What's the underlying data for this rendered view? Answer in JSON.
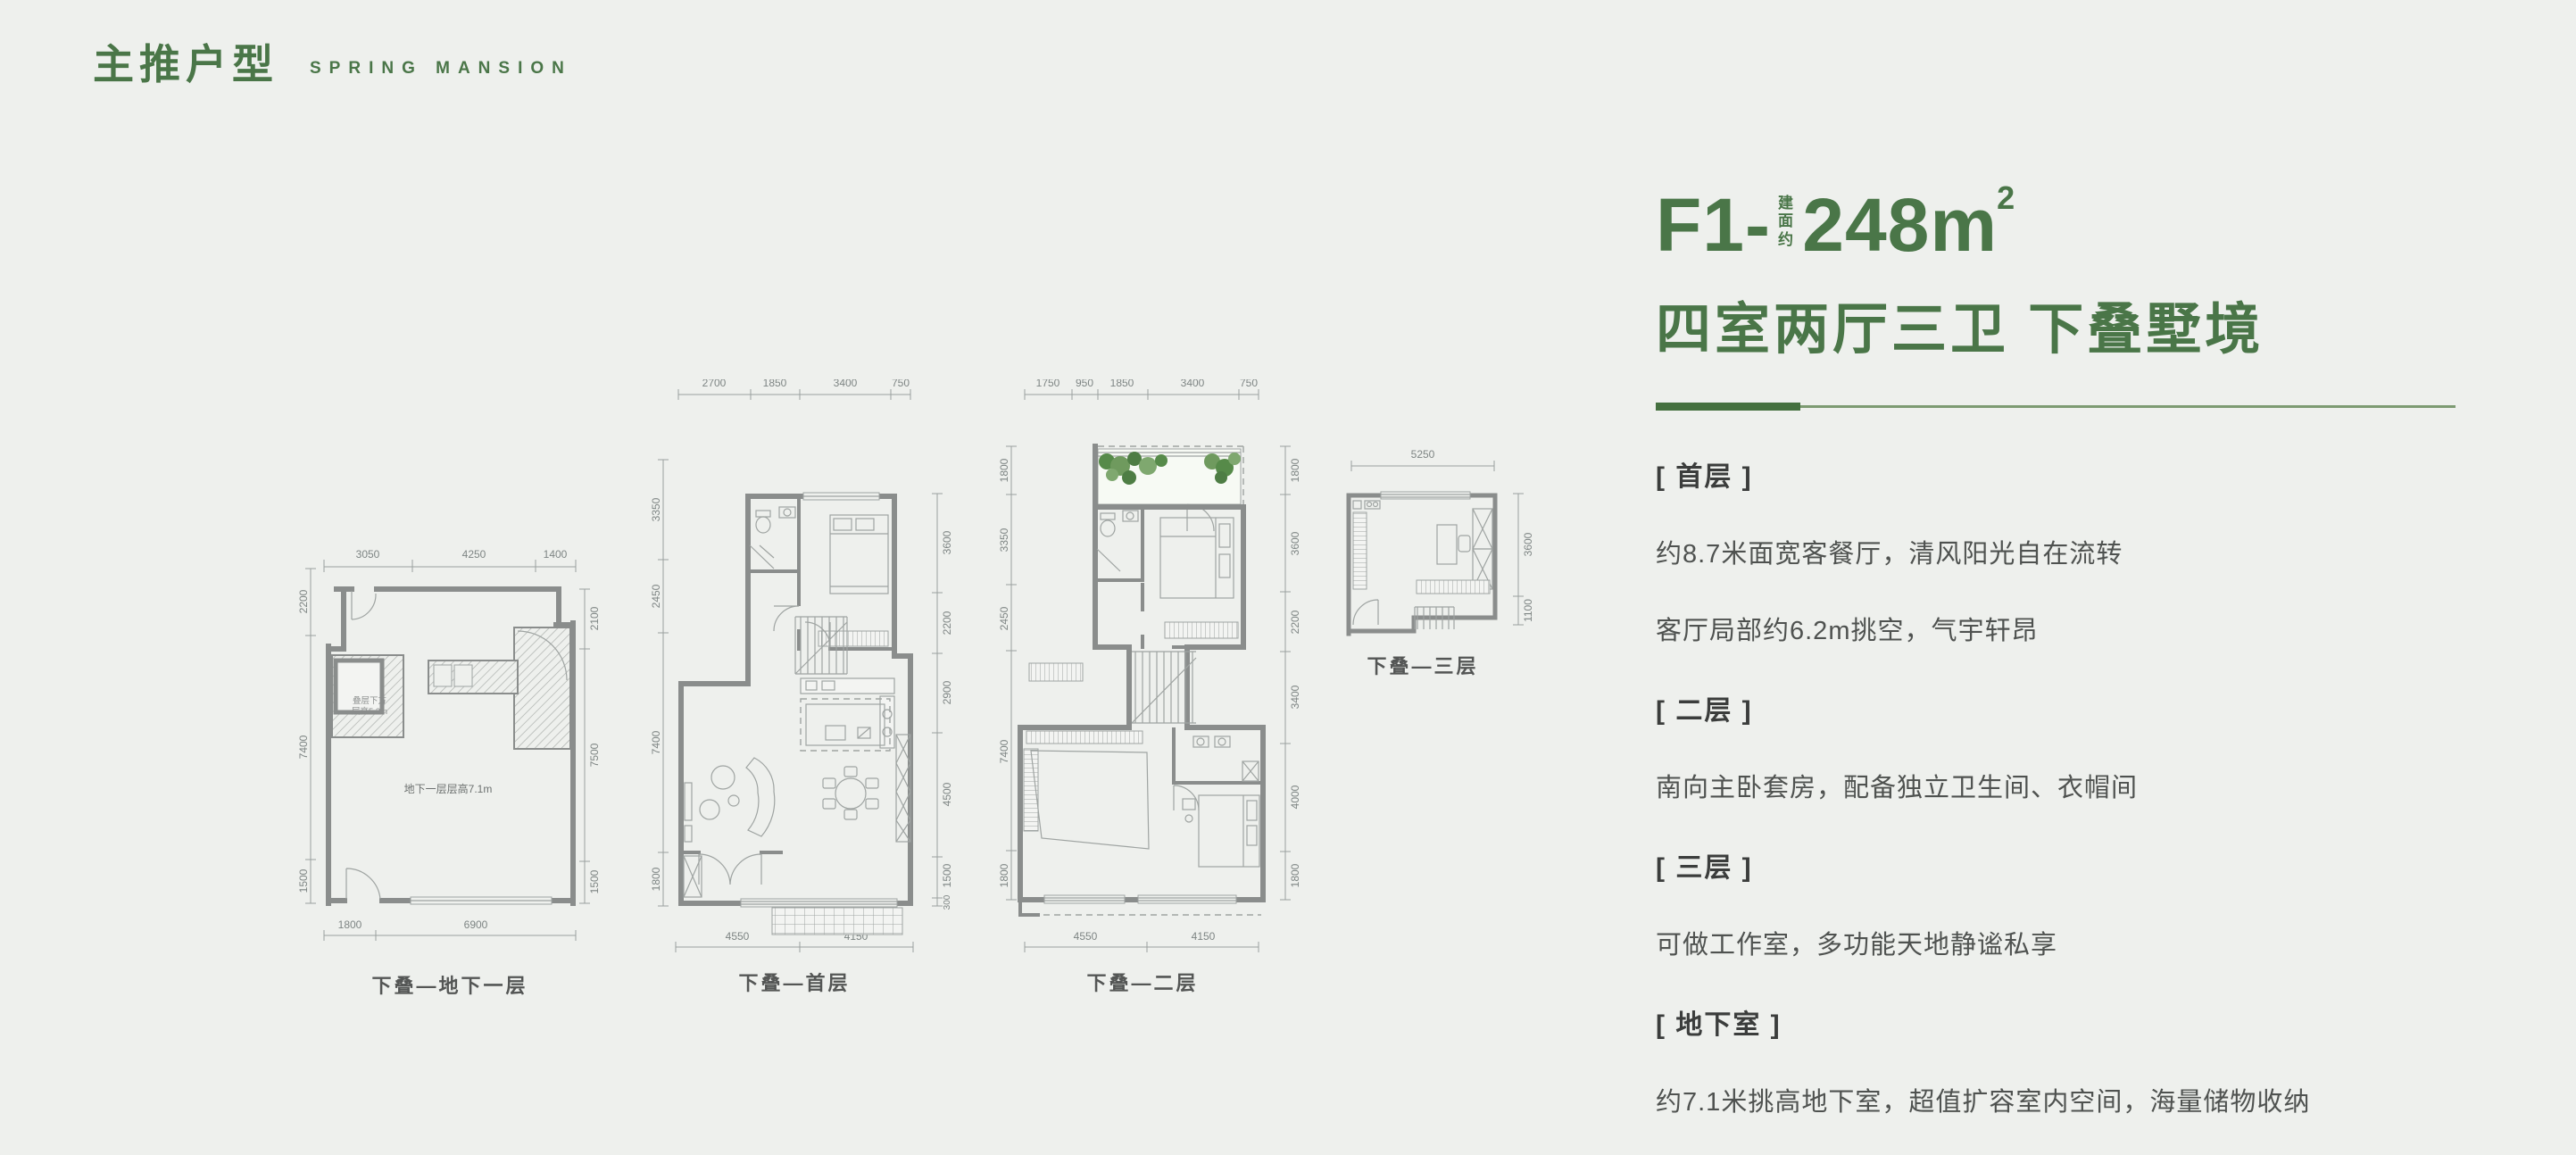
{
  "theme": {
    "accent_green": "#4a7648",
    "background": "#eef0ed",
    "wall_gray": "#8a8d8c",
    "body_text": "#4f5250",
    "heading_text": "#3b3d3c",
    "dim_text": "#7e8584"
  },
  "header": {
    "title_cn": "主推户型",
    "title_en": "SPRING MANSION"
  },
  "unit": {
    "code": "F1-",
    "area_prefix": "建面约",
    "area_value": "248",
    "area_unit": "m",
    "area_sup": "2",
    "subtitle": "四室两厅三卫 下叠墅境"
  },
  "sections": [
    {
      "label": "[ 首层 ]",
      "lines": [
        "约8.7米面宽客餐厅，清风阳光自在流转",
        "客厅局部约6.2m挑空，气宇轩昂"
      ]
    },
    {
      "label": "[ 二层 ]",
      "lines": [
        "南向主卧套房，配备独立卫生间、衣帽间"
      ]
    },
    {
      "label": "[ 三层 ]",
      "lines": [
        "可做工作室，多功能天地静谧私享"
      ]
    },
    {
      "label": "[ 地下室 ]",
      "lines": [
        "约7.1米挑高地下室，超值扩容室内空间，海量储物收纳"
      ]
    }
  ],
  "plans": [
    {
      "caption": "下叠—地下一层",
      "note": "地下一层层高7.1m",
      "hatch_note_1": "叠层下方",
      "hatch_note_2": "层高5.3m",
      "dims": {
        "top": [
          "3050",
          "4250",
          "1400"
        ],
        "left": [
          "2200",
          "7400",
          "1500"
        ],
        "right": [
          "2100",
          "7500",
          "1500"
        ],
        "bottom": [
          "1800",
          "6900"
        ]
      }
    },
    {
      "caption": "下叠—首层",
      "dims": {
        "top": [
          "2700",
          "1850",
          "3400",
          "750"
        ],
        "left": [
          "3350",
          "2450",
          "7400",
          "1800"
        ],
        "right": [
          "3600",
          "2200",
          "2900",
          "4500",
          "1500",
          "300"
        ],
        "bottom": [
          "4550",
          "4150"
        ]
      }
    },
    {
      "caption": "下叠—二层",
      "dims": {
        "top": [
          "1750",
          "950",
          "1850",
          "3400",
          "750"
        ],
        "left": [
          "1800",
          "3350",
          "2450",
          "7400",
          "1800"
        ],
        "right": [
          "1800",
          "3600",
          "2200",
          "3400",
          "4000",
          "1800"
        ],
        "bottom": [
          "4550",
          "4150"
        ]
      }
    },
    {
      "caption": "下叠—三层",
      "dims": {
        "top": [
          "5250"
        ],
        "right": [
          "3600",
          "1100"
        ]
      }
    }
  ]
}
